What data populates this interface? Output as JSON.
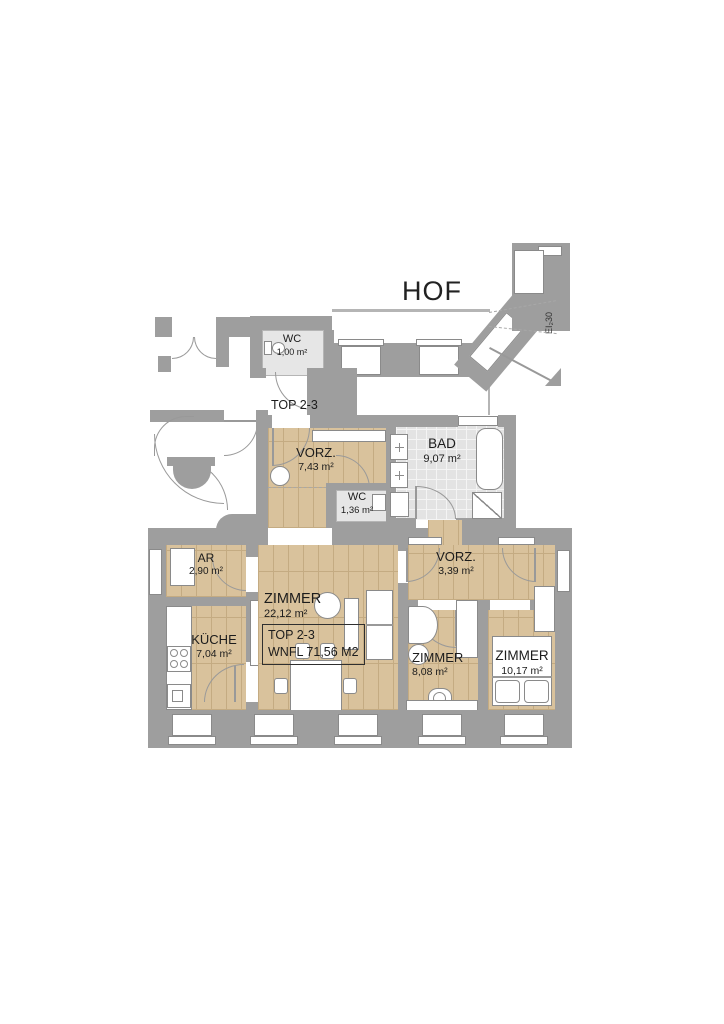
{
  "labels": {
    "courtyard": "HOF",
    "unit_top": "TOP 2-3",
    "fire_rating": "EI₂30"
  },
  "info_box": {
    "line1": "TOP 2-3",
    "line2": "WNFL 71,56 M2"
  },
  "rooms": [
    {
      "name": "WC",
      "area": "1,00 m²"
    },
    {
      "name": "VORZ.",
      "area": "7,43 m²"
    },
    {
      "name": "BAD",
      "area": "9,07 m²"
    },
    {
      "name": "WC",
      "area": "1,36 m²"
    },
    {
      "name": "AR",
      "area": "2,90 m²"
    },
    {
      "name": "VORZ.",
      "area": "3,39 m²"
    },
    {
      "name": "ZIMMER",
      "area": "22,12 m²"
    },
    {
      "name": "KÜCHE",
      "area": "7,04 m²"
    },
    {
      "name": "ZIMMER",
      "area": "8,08 m²"
    },
    {
      "name": "ZIMMER",
      "area": "10,17 m²"
    }
  ],
  "colors": {
    "wall": "#9e9e9e",
    "wood": "#d9c29c",
    "wood_line": "#c4ab82",
    "tile": "#e3e3e3",
    "tile_line": "#f4f4f4",
    "floor_light": "#e6e6e6",
    "stroke": "#8a8a8a",
    "line": "#999999",
    "text": "#1c1c1c"
  }
}
